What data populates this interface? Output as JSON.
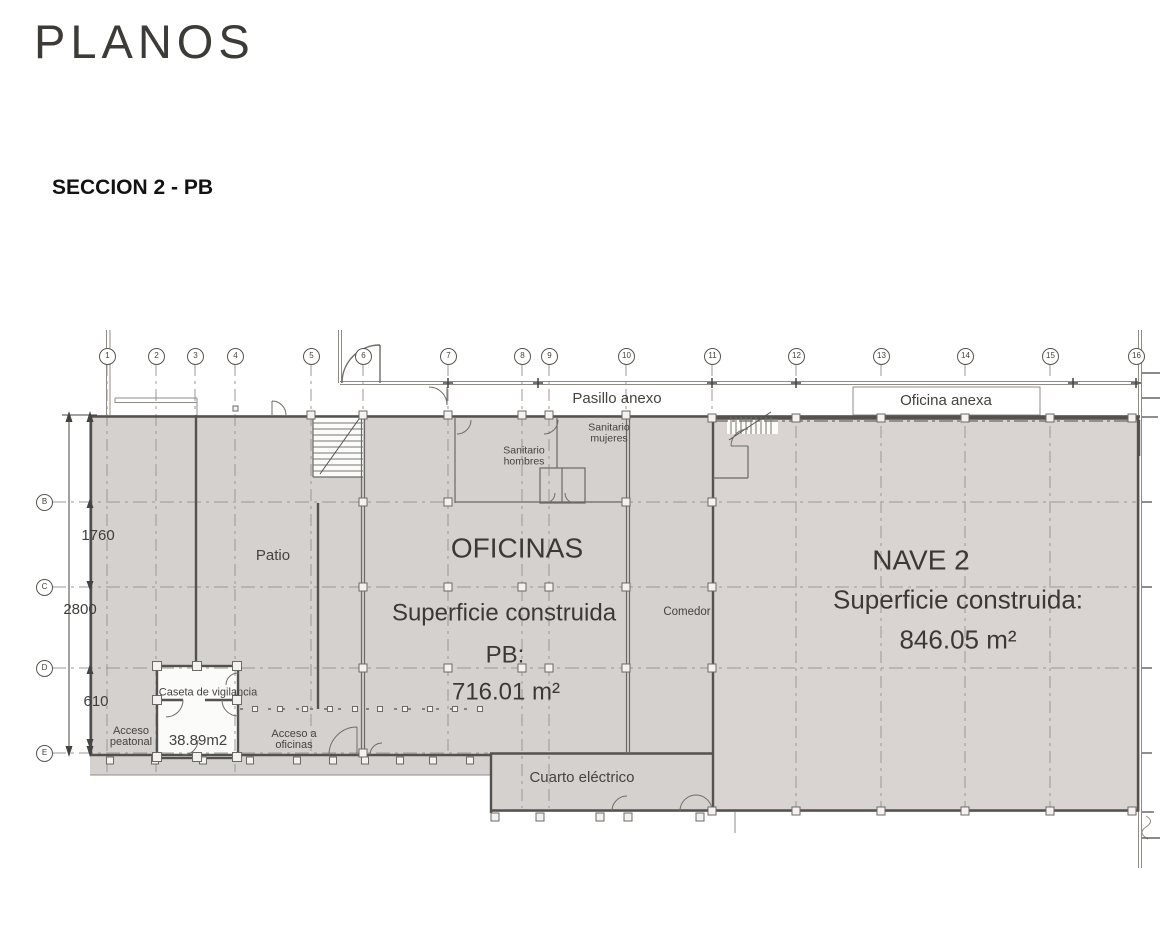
{
  "header": {
    "title": "PLANOS",
    "section": "SECCION 2 - PB"
  },
  "plan": {
    "grid_columns": [
      "1",
      "2",
      "3",
      "4",
      "5",
      "6",
      "7",
      "8",
      "9",
      "10",
      "11",
      "12",
      "13",
      "14",
      "15",
      "16"
    ],
    "grid_rows": [
      "B",
      "C",
      "D",
      "E"
    ],
    "dimensions": {
      "total": "2800",
      "upper": "1760",
      "lower": "610"
    },
    "annexes": {
      "pasillo": "Pasillo anexo",
      "oficina": "Oficina anexa"
    },
    "rooms": {
      "patio": "Patio",
      "oficinas_title": "OFICINAS",
      "oficinas_line1": "Superficie construida",
      "oficinas_line2": "PB:",
      "oficinas_area": "716.01 m²",
      "nave_title": "NAVE 2",
      "nave_line1": "Superficie construida:",
      "nave_area": "846.05 m²",
      "comedor": "Comedor",
      "sanitario_hombres_l1": "Sanitario",
      "sanitario_hombres_l2": "hombres",
      "sanitario_mujeres_l1": "Sanitario",
      "sanitario_mujeres_l2": "mujeres",
      "cuarto_electrico": "Cuarto eléctrico",
      "caseta": "Caseta de vigilancia",
      "caseta_area": "38.89m2",
      "acceso_peatonal_l1": "Acceso",
      "acceso_peatonal_l2": "peatonal",
      "acceso_oficinas_l1": "Acceso a",
      "acceso_oficinas_l2": "oficinas"
    },
    "colors": {
      "plan_fill": "#d4d1ce",
      "nave_fill": "#d9d4d1",
      "wall": "#54524e",
      "thin_line": "#8f8c88",
      "grid_dash": "#9b9894",
      "text": "#45433f"
    }
  }
}
